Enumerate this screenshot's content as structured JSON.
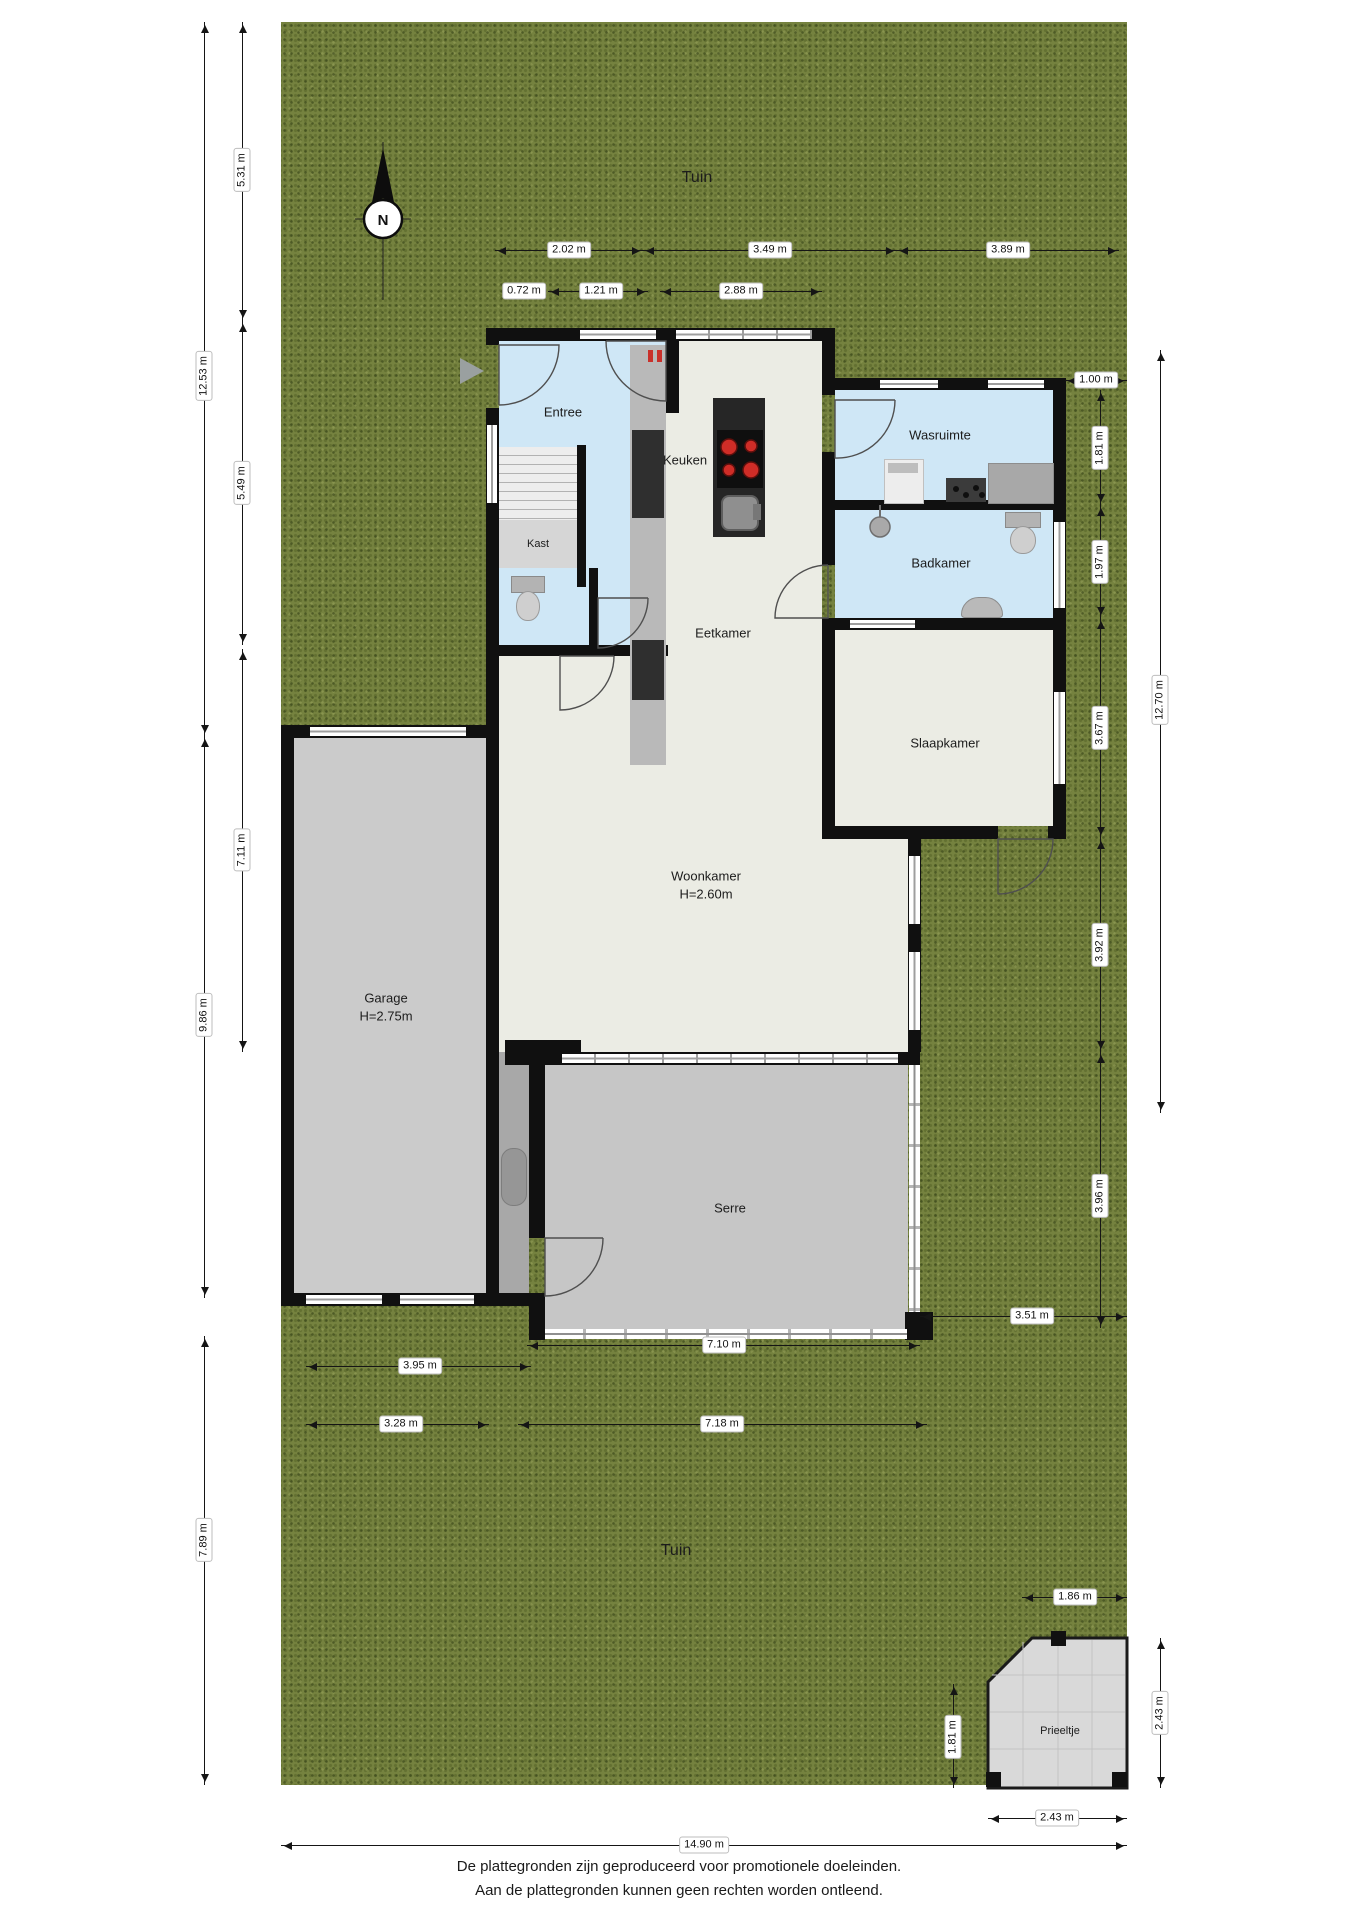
{
  "garden": {
    "label_top": "Tuin",
    "label_bottom": "Tuin"
  },
  "compass": {
    "label": "N"
  },
  "rooms": {
    "entree": "Entree",
    "kast": "Kast",
    "keuken": "Keuken",
    "eetkamer": "Eetkamer",
    "wasruimte": "Wasruimte",
    "badkamer": "Badkamer",
    "slaapkamer": "Slaapkamer",
    "woonkamer": "Woonkamer",
    "woonkamer_height": "H=2.60m",
    "garage": "Garage",
    "garage_height": "H=2.75m",
    "serre": "Serre",
    "prieeltje": "Prieeltje"
  },
  "dims": {
    "top_202": "2.02 m",
    "top_349": "3.49 m",
    "top_389": "3.89 m",
    "top_072": "0.72 m",
    "top_121": "1.21 m",
    "top_288": "2.88 m",
    "left_531": "5.31 m",
    "left_1253": "12.53 m",
    "left_549": "5.49 m",
    "left_711": "7.11 m",
    "left_986": "9.86 m",
    "left_789": "7.89 m",
    "right_100": "1.00 m",
    "right_181": "1.81 m",
    "right_197": "1.97 m",
    "right_367": "3.67 m",
    "right_392": "3.92 m",
    "right_396": "3.96 m",
    "right_1270": "12.70 m",
    "right_351": "3.51 m",
    "bottom_710": "7.10 m",
    "bottom_395": "3.95 m",
    "bottom_328": "3.28 m",
    "bottom_718": "7.18 m",
    "bottom_1490": "14.90 m",
    "pri_186": "1.86 m",
    "pri_181": "1.81 m",
    "pri_243v": "2.43 m",
    "pri_243h": "2.43 m"
  },
  "footer": {
    "line1": "De plattegronden zijn geproduceerd voor promotionele doeleinden.",
    "line2": "Aan de plattegronden kunnen geen rechten worden ontleend."
  },
  "colors": {
    "garden": "#75823f",
    "wall": "#101010",
    "blue_room": "#cfe7f6",
    "cream_room": "#ebece4",
    "garage_gray": "#cbcbcb",
    "serre_gray": "#c6c6c6",
    "accent_red": "#c9302a"
  }
}
